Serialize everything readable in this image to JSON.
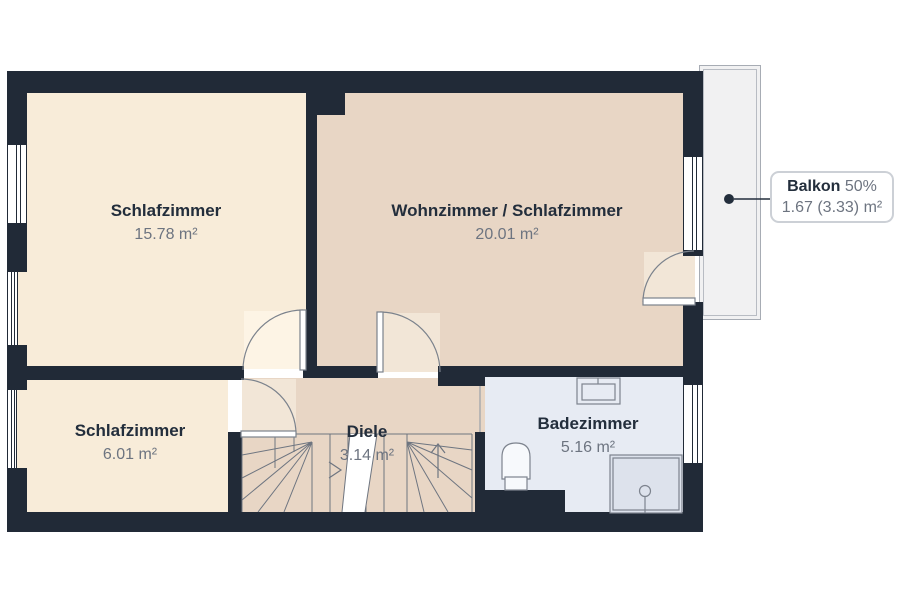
{
  "rooms": {
    "bedroom_large": {
      "name": "Schlafzimmer",
      "area": "15.78 m²"
    },
    "living": {
      "name": "Wohnzimmer / Schlafzimmer",
      "area": "20.01 m²"
    },
    "bedroom_small": {
      "name": "Schlafzimmer",
      "area": "6.01 m²"
    },
    "hallway": {
      "name": "Diele",
      "area": "3.14 m²"
    },
    "bathroom": {
      "name": "Badezimmer",
      "area": "5.16 m²"
    }
  },
  "balcony_callout": {
    "title": "Balkon",
    "share": "50%",
    "area": "1.67 (3.33) m²"
  },
  "colors": {
    "wall": "#212a37",
    "bedroom_fill": "#f8ecd9",
    "living_fill": "#e8d6c5",
    "hallway_fill": "#e8d6c5",
    "bathroom_fill": "#e7ebf3",
    "shower_fill": "#dde2ec",
    "balcony_fill": "#f1f1f2",
    "swing_cream": "#fdf4e5",
    "swing_tan": "#f2e6d7",
    "text_dark": "#232e3c",
    "text_gray": "#6d7480",
    "line_gray": "#6e7580"
  }
}
